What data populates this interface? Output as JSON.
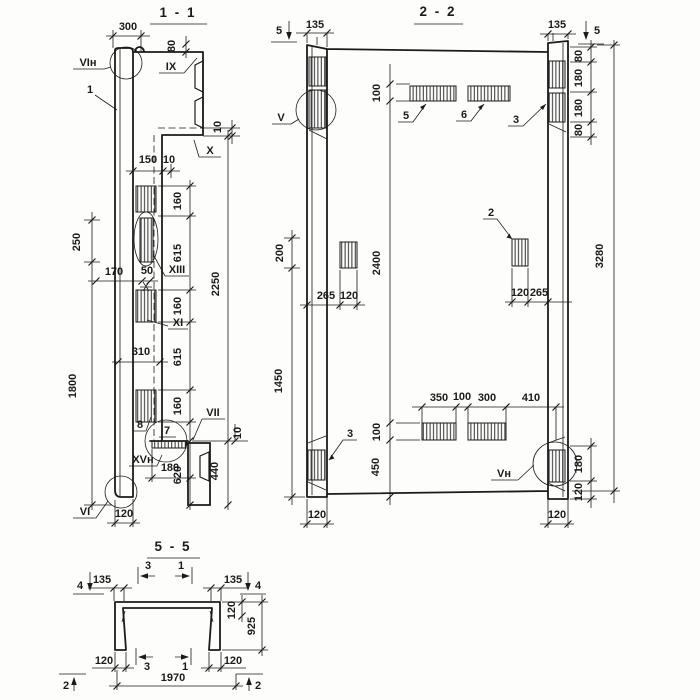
{
  "s11": {
    "title": "1 - 1",
    "d300": "300",
    "d80": "80",
    "d10a": "10",
    "d150": "150",
    "d10b": "10",
    "d250": "250",
    "d1800": "1800",
    "d160a": "160",
    "d615a": "615",
    "d160b": "160",
    "d615b": "615",
    "d160c": "160",
    "d2250": "2250",
    "d170": "170",
    "d50": "50",
    "d310": "310",
    "d10c": "10",
    "d180": "180",
    "d620": "620",
    "d440": "440",
    "d120": "120",
    "mVIh": "VIн",
    "mIX": "IX",
    "mX": "X",
    "mXIII": "XIII",
    "mXI": "XI",
    "mVII": "VII",
    "mXVh": "XVн",
    "mVI": "VI",
    "c1": "1",
    "c7": "7",
    "c8": "8"
  },
  "s22": {
    "title": "2 - 2",
    "cut5l": "5",
    "cut5r": "5",
    "d135l": "135",
    "d135r": "135",
    "d100t": "100",
    "d2400": "2400",
    "d100b": "100",
    "d450": "450",
    "d200": "200",
    "d1450": "1450",
    "d265l": "265",
    "d120l": "120",
    "d120r2": "120",
    "d265r": "265",
    "d3280": "3280",
    "d80a": "80",
    "d180a": "180",
    "d180b": "180",
    "d80b": "80",
    "d350": "350",
    "d100m": "100",
    "d300": "300",
    "d410": "410",
    "d180c": "180",
    "d120c": "120",
    "d120bl": "120",
    "d120br": "120",
    "mV": "V",
    "mVh": "Vн",
    "c2": "2",
    "c3l": "3",
    "c3r": "3",
    "c5": "5",
    "c6": "6"
  },
  "s55": {
    "title": "5 - 5",
    "d135l": "135",
    "d135r": "135",
    "d120v": "120",
    "d925": "925",
    "d120bl": "120",
    "d120br": "120",
    "d1970": "1970",
    "cut4l": "4",
    "cut4r": "4",
    "cut3t": "3",
    "cut1t": "1",
    "cut3b": "3",
    "cut1b": "1",
    "cut2l": "2",
    "cut2r": "2"
  }
}
